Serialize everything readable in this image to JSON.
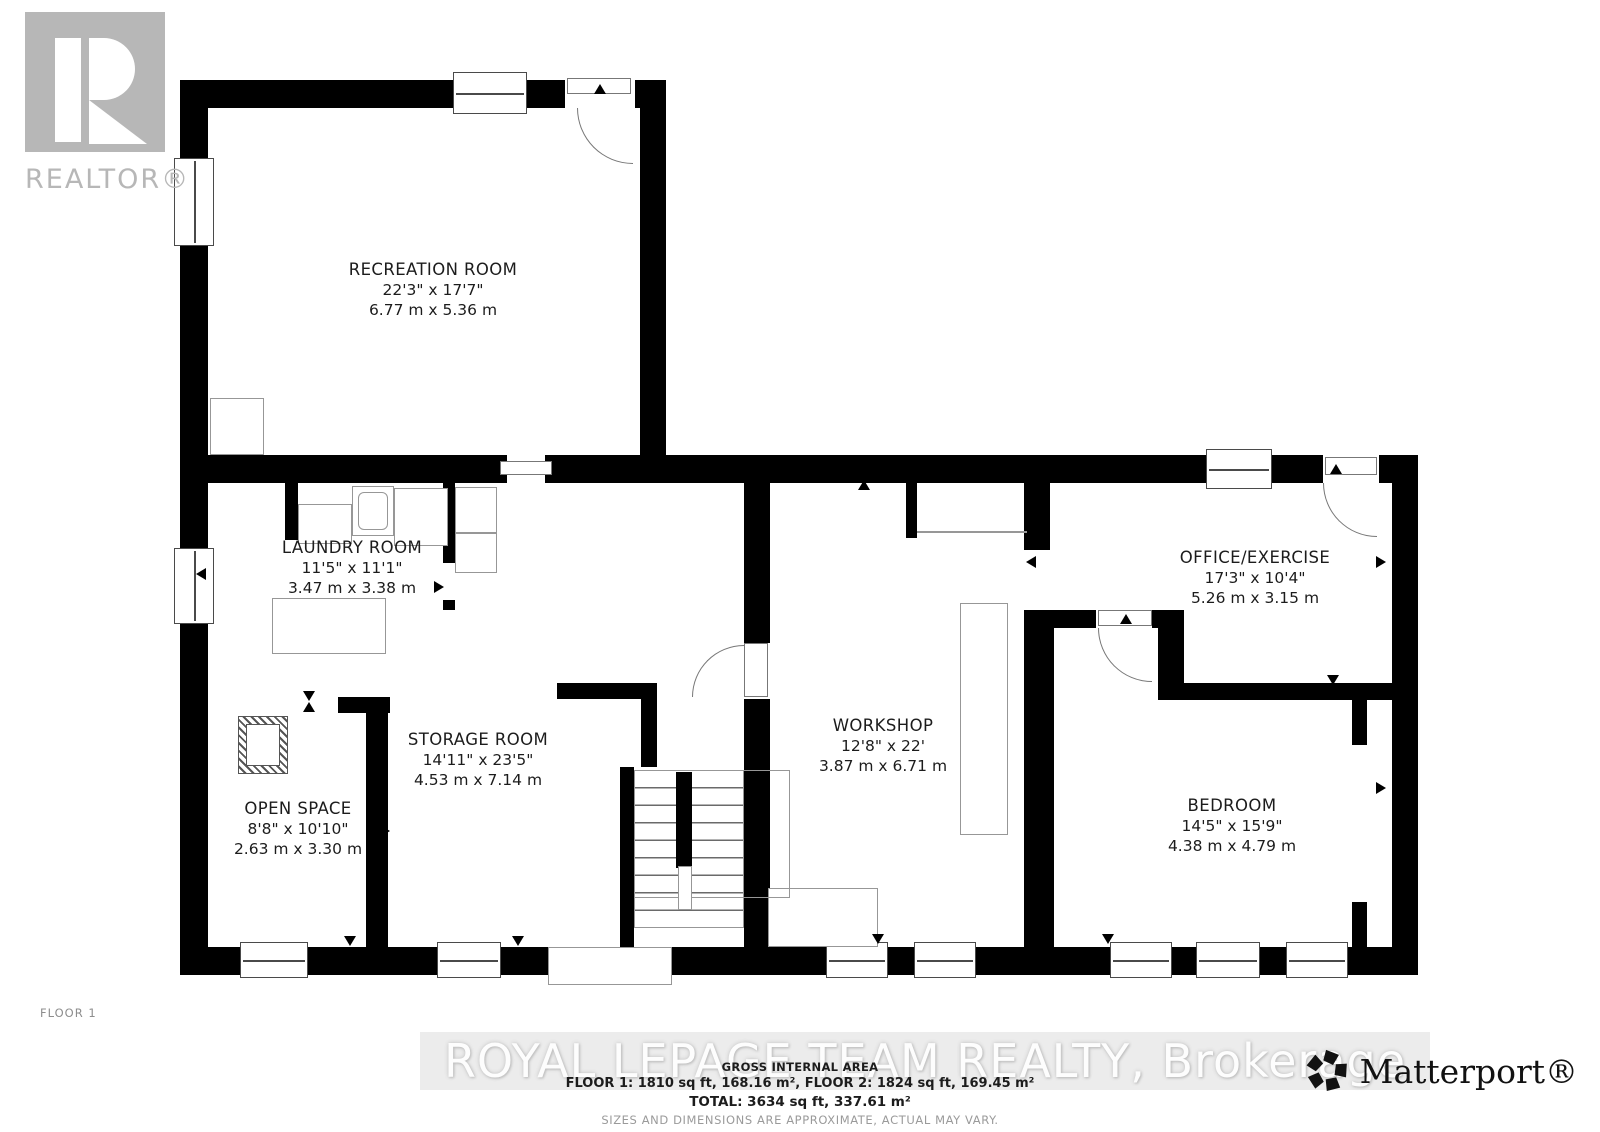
{
  "branding": {
    "realtor_logo": "REALTOR®",
    "floor_label": "FLOOR 1",
    "watermark": "ROYAL LEPAGE TEAM REALTY, Brokerage",
    "matterport_logo": "Matterport®"
  },
  "rooms": [
    {
      "name": "RECREATION ROOM",
      "imperial": "22'3\" x 17'7\"",
      "metric": "6.77 m x 5.36 m"
    },
    {
      "name": "LAUNDRY ROOM",
      "imperial": "11'5\" x 11'1\"",
      "metric": "3.47 m x 3.38 m"
    },
    {
      "name": "STORAGE ROOM",
      "imperial": "14'11\" x 23'5\"",
      "metric": "4.53 m x 7.14 m"
    },
    {
      "name": "OPEN SPACE",
      "imperial": "8'8\" x 10'10\"",
      "metric": "2.63 m x 3.30 m"
    },
    {
      "name": "WORKSHOP",
      "imperial": "12'8\" x 22'",
      "metric": "3.87 m x 6.71 m"
    },
    {
      "name": "OFFICE/EXERCISE",
      "imperial": "17'3\" x 10'4\"",
      "metric": "5.26 m x 3.15 m"
    },
    {
      "name": "BEDROOM",
      "imperial": "14'5\" x 15'9\"",
      "metric": "4.38 m x 4.79 m"
    }
  ],
  "area_summary": {
    "title": "GROSS INTERNAL AREA",
    "floor_breakdown": "FLOOR 1: 1810 sq ft, 168.16 m², FLOOR 2: 1824 sq ft, 169.45 m²",
    "total": "TOTAL: 3634 sq ft, 337.61 m²",
    "disclaimer": "SIZES AND DIMENSIONS ARE APPROXIMATE, ACTUAL MAY VARY."
  },
  "colors": {
    "wall": "#000000",
    "outline": "#979797",
    "watermark_gray": "#b7b7b7",
    "band_gray": "#ececec"
  }
}
